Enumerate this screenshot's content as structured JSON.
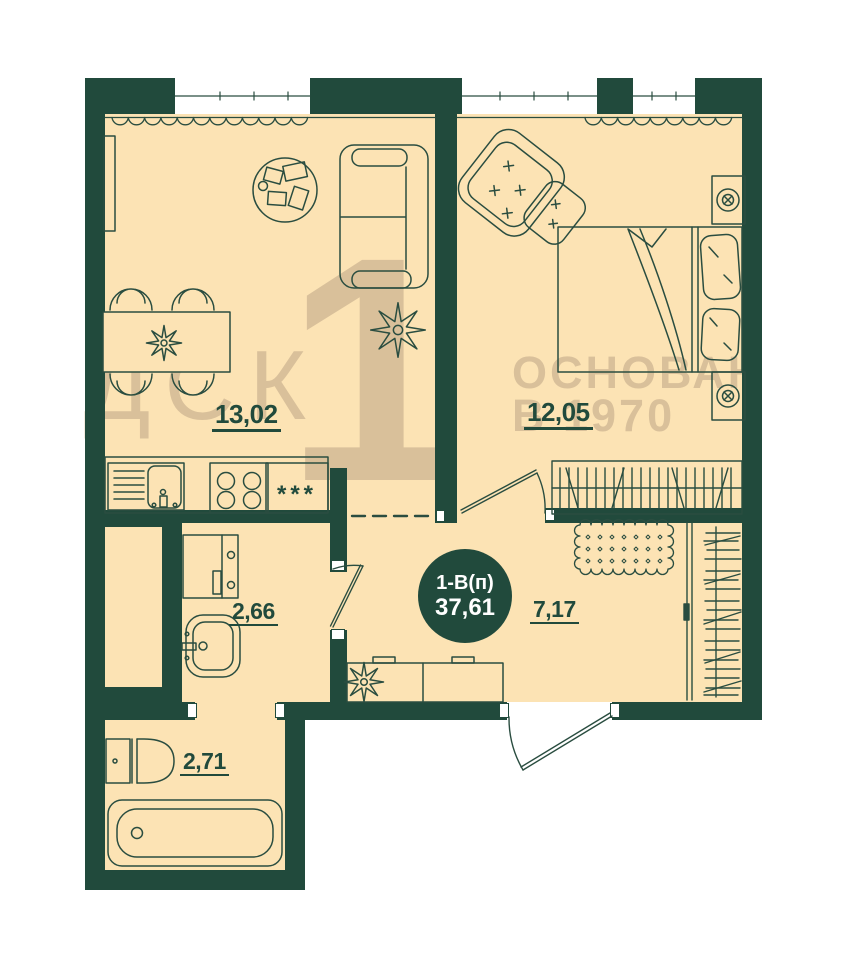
{
  "floor_plan": {
    "badge": {
      "layout_code": "1-В(п)",
      "total_area": "37,61"
    },
    "rooms": {
      "kitchen_living": {
        "area": "13,02"
      },
      "bedroom": {
        "area": "12,05"
      },
      "laundry": {
        "area": "2,66"
      },
      "bathroom": {
        "area": "2,71"
      },
      "hallway": {
        "area": "7,17"
      }
    },
    "kitchen_cabinet_marker": "***",
    "watermarks": {
      "brand": "ДСК",
      "big_digit": "1",
      "founded_line1": "ОСНОВАН",
      "founded_line2": "В 1970"
    },
    "colors": {
      "wall_dark_green": "#214a3c",
      "floor_beige": "#fce3b4",
      "watermark_tan": "#d9c09a",
      "furniture_line_green": "#2a4d40",
      "page_background": "#ffffff",
      "badge_text": "#ffffff"
    }
  }
}
